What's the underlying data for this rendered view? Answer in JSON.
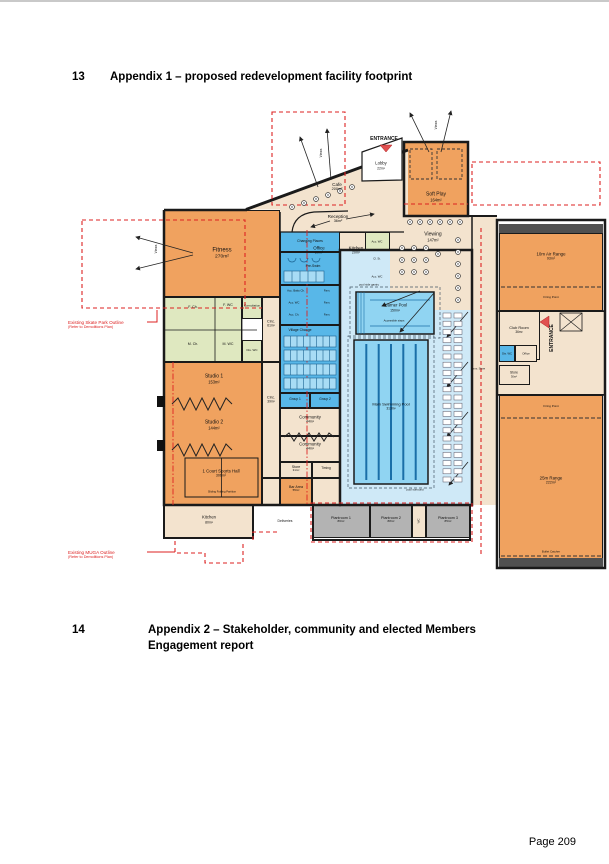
{
  "page": {
    "heading1": {
      "num": "13",
      "title": "Appendix 1 – proposed redevelopment facility footprint"
    },
    "heading2": {
      "num": "14",
      "title": "Appendix 2 – Stakeholder, community and elected Members",
      "title_line2": "Engagement report"
    },
    "footer": {
      "page_label": "Page 209"
    }
  },
  "colors": {
    "wall": "#1A1A1A",
    "red": "#DD2222",
    "orange": "#F0A25F",
    "tan": "#F3E3CE",
    "green": "#DFE8C0",
    "blue": "#58B7E8",
    "poolFloor": "#CFE9F7",
    "water": "#90D4F2",
    "gray": "#B3B3B3",
    "dark": "#505050",
    "laneBlue": "#1A6FA8",
    "entrancePink": "#E05050"
  },
  "plan": {
    "rooms": [
      {
        "name": "room-fitness",
        "x": 164,
        "y": 210,
        "w": 116,
        "h": 87,
        "f": "orange"
      },
      {
        "name": "room-change-strip",
        "x": 164,
        "y": 297,
        "w": 78,
        "h": 65,
        "f": "green"
      },
      {
        "name": "room-consultation",
        "x": 242,
        "y": 297,
        "w": 20,
        "h": 22,
        "f": "green"
      },
      {
        "name": "room-dis-wc-left",
        "x": 242,
        "y": 340,
        "w": 20,
        "h": 22,
        "f": "green"
      },
      {
        "name": "room-circ-61",
        "x": 262,
        "y": 297,
        "w": 18,
        "h": 65,
        "f": "tan"
      },
      {
        "name": "room-studios",
        "x": 164,
        "y": 362,
        "w": 98,
        "h": 143,
        "f": "orange"
      },
      {
        "name": "room-circ-39",
        "x": 262,
        "y": 362,
        "w": 18,
        "h": 116,
        "f": "tan"
      },
      {
        "name": "room-south-corridor",
        "x": 262,
        "y": 478,
        "w": 18,
        "h": 27,
        "f": "tan"
      },
      {
        "name": "room-kitchen-bottom",
        "x": 164,
        "y": 505,
        "w": 89,
        "h": 33,
        "f": "tan"
      },
      {
        "name": "room-reception-zone",
        "x": 280,
        "y": 212,
        "w": 124,
        "h": 20,
        "f": "tan",
        "nb": 1
      },
      {
        "name": "room-office",
        "x": 300,
        "y": 232,
        "w": 38,
        "h": 38,
        "f": "tan"
      },
      {
        "name": "room-kitchen-20",
        "x": 338,
        "y": 232,
        "w": 36,
        "h": 38,
        "f": "tan"
      },
      {
        "name": "room-wc-block",
        "x": 365,
        "y": 232,
        "w": 25,
        "h": 56,
        "f": "green"
      },
      {
        "name": "room-changing-places",
        "x": 280,
        "y": 230,
        "w": 60,
        "h": 22,
        "f": "blue"
      },
      {
        "name": "room-pre-swim",
        "x": 280,
        "y": 252,
        "w": 60,
        "h": 33,
        "f": "blue"
      },
      {
        "name": "room-acc-change",
        "x": 280,
        "y": 285,
        "w": 60,
        "h": 40,
        "f": "blue"
      },
      {
        "name": "room-village-change",
        "x": 280,
        "y": 325,
        "w": 60,
        "h": 68,
        "f": "blue"
      },
      {
        "name": "room-group-1",
        "x": 280,
        "y": 393,
        "w": 30,
        "h": 15,
        "f": "blue"
      },
      {
        "name": "room-group-2",
        "x": 310,
        "y": 393,
        "w": 30,
        "h": 15,
        "f": "blue"
      },
      {
        "name": "room-community-1",
        "x": 280,
        "y": 408,
        "w": 60,
        "h": 28,
        "f": "tan"
      },
      {
        "name": "room-community-2",
        "x": 280,
        "y": 436,
        "w": 60,
        "h": 26,
        "f": "tan"
      },
      {
        "name": "room-store-31",
        "x": 280,
        "y": 462,
        "w": 32,
        "h": 16,
        "f": "tan"
      },
      {
        "name": "room-timing",
        "x": 312,
        "y": 462,
        "w": 28,
        "h": 16,
        "f": "tan"
      },
      {
        "name": "room-bar-area",
        "x": 280,
        "y": 478,
        "w": 32,
        "h": 27,
        "f": "orange"
      },
      {
        "name": "room-pool-store",
        "x": 312,
        "y": 478,
        "w": 28,
        "h": 27,
        "f": "tan"
      },
      {
        "name": "room-pool-hall",
        "x": 340,
        "y": 250,
        "w": 132,
        "h": 255,
        "f": "poolFloor"
      },
      {
        "name": "room-viewing",
        "x": 390,
        "y": 216,
        "w": 107,
        "h": 94,
        "f": "tan",
        "nb": 1
      },
      {
        "name": "room-east-corridor",
        "x": 472,
        "y": 216,
        "w": 25,
        "h": 289,
        "f": "tan",
        "nb": 1
      },
      {
        "name": "room-soft-play",
        "x": 404,
        "y": 142,
        "w": 64,
        "h": 74,
        "f": "orange"
      },
      {
        "name": "room-wing-mid",
        "x": 497,
        "y": 311,
        "w": 108,
        "h": 84,
        "f": "tan"
      },
      {
        "name": "room-club-room",
        "x": 499,
        "y": 311,
        "w": 41,
        "h": 49,
        "f": "tan"
      },
      {
        "name": "room-dis-wc-wing",
        "x": 499,
        "y": 345,
        "w": 16,
        "h": 17,
        "f": "blue"
      },
      {
        "name": "room-office-wing",
        "x": 515,
        "y": 345,
        "w": 22,
        "h": 17,
        "f": "tan"
      },
      {
        "name": "room-store-30",
        "x": 499,
        "y": 365,
        "w": 31,
        "h": 20,
        "f": "tan"
      },
      {
        "name": "room-bullet-catcher-top",
        "x": 499,
        "y": 224,
        "w": 104,
        "h": 9,
        "f": "dark",
        "nb": 1
      },
      {
        "name": "room-air-range",
        "x": 499,
        "y": 233,
        "w": 104,
        "h": 78,
        "f": "orange"
      },
      {
        "name": "room-25m-range",
        "x": 499,
        "y": 395,
        "w": 104,
        "h": 173,
        "f": "orange"
      },
      {
        "name": "room-bullet-catcher-bottom",
        "x": 499,
        "y": 558,
        "w": 104,
        "h": 9,
        "f": "dark",
        "nb": 1
      },
      {
        "name": "room-plantroom-1",
        "x": 313,
        "y": 505,
        "w": 57,
        "h": 33,
        "f": "gray"
      },
      {
        "name": "room-plantroom-2",
        "x": 370,
        "y": 505,
        "w": 42,
        "h": 33,
        "f": "gray"
      },
      {
        "name": "room-wc-plant",
        "x": 412,
        "y": 505,
        "w": 14,
        "h": 33,
        "f": "tan"
      },
      {
        "name": "room-plantroom-3",
        "x": 426,
        "y": 505,
        "w": 44,
        "h": 33,
        "f": "gray"
      }
    ],
    "labels": [
      {
        "name": "fitness-label",
        "t": "Fitness",
        "s": "270m²",
        "x": 222,
        "y": 254,
        "fs": 6
      },
      {
        "name": "f-ch-label",
        "t": "F. Ch.",
        "x": 193,
        "y": 307,
        "fs": 3.6
      },
      {
        "name": "f-wc-label",
        "t": "F. WC",
        "x": 228,
        "y": 305,
        "fs": 3.6
      },
      {
        "name": "m-ch-label",
        "t": "M. Ch.",
        "x": 193,
        "y": 344,
        "fs": 3.6
      },
      {
        "name": "m-wc-label",
        "t": "M. WC",
        "x": 228,
        "y": 344,
        "fs": 3.6
      },
      {
        "name": "consultation-label",
        "t": "Consultation",
        "x": 252,
        "y": 306,
        "fs": 2.9
      },
      {
        "name": "dis-wc-left-label",
        "t": "Dis. WC",
        "x": 252,
        "y": 351,
        "fs": 3
      },
      {
        "name": "circ-61-label",
        "t": "Circ.",
        "s": "61m²",
        "x": 271,
        "y": 324,
        "fs": 4
      },
      {
        "name": "studio-1-label",
        "t": "Studio 1",
        "s": "153m²",
        "x": 214,
        "y": 380,
        "fs": 5
      },
      {
        "name": "studio-2-label",
        "t": "Studio 2",
        "s": "144m²",
        "x": 214,
        "y": 426,
        "fs": 5
      },
      {
        "name": "sports-hall-label",
        "t": "1 Court Sports Hall",
        "s": "306m²",
        "x": 221,
        "y": 473,
        "fs": 4.4,
        "w": 54
      },
      {
        "name": "circ-39-label",
        "t": "Circ.",
        "s": "39m²",
        "x": 271,
        "y": 400,
        "fs": 4
      },
      {
        "name": "kitchen-bottom-label",
        "t": "Kitchen",
        "s": "80m²",
        "x": 209,
        "y": 520,
        "fs": 4.2
      },
      {
        "name": "changing-places-label",
        "t": "Changing Places",
        "x": 310,
        "y": 241,
        "fs": 3.4
      },
      {
        "name": "pre-swim-label",
        "t": "Pre-Swim",
        "x": 313,
        "y": 266,
        "fs": 3.4
      },
      {
        "name": "acc-baby-ch-label",
        "t": "Acc. Baby Ch.",
        "x": 296,
        "y": 291,
        "fs": 2.8
      },
      {
        "name": "acc-wc-central-label",
        "t": "Acc. WC",
        "x": 294,
        "y": 303,
        "fs": 2.8
      },
      {
        "name": "acc-ch-label",
        "t": "Acc. Ch.",
        "x": 294,
        "y": 315,
        "fs": 2.8
      },
      {
        "name": "fam-1-label",
        "t": "Fam.",
        "x": 327,
        "y": 291,
        "fs": 2.8
      },
      {
        "name": "fam-2-label",
        "t": "Fam.",
        "x": 327,
        "y": 303,
        "fs": 2.8
      },
      {
        "name": "fam-3-label",
        "t": "Fam.",
        "x": 327,
        "y": 315,
        "fs": 2.8
      },
      {
        "name": "village-change-label",
        "t": "Village Change",
        "x": 300,
        "y": 330,
        "fs": 3.4
      },
      {
        "name": "group-1-label",
        "t": "Group 1",
        "x": 295,
        "y": 400,
        "fs": 3.2
      },
      {
        "name": "group-2-label",
        "t": "Group 2",
        "x": 325,
        "y": 400,
        "fs": 3.2
      },
      {
        "name": "community-1-label",
        "t": "Community",
        "s": "44m²",
        "x": 310,
        "y": 419,
        "fs": 4.3
      },
      {
        "name": "community-2-label",
        "t": "Community",
        "s": "44m²",
        "x": 310,
        "y": 446,
        "fs": 4.3
      },
      {
        "name": "store-31-label",
        "t": "Store",
        "s": "31m²",
        "x": 296,
        "y": 469,
        "fs": 3.6
      },
      {
        "name": "timing-label",
        "t": "Timing",
        "x": 326,
        "y": 469,
        "fs": 3.2
      },
      {
        "name": "bar-area-label",
        "t": "Bar Area",
        "s": "55m²",
        "x": 296,
        "y": 489,
        "fs": 3.6
      },
      {
        "name": "cafe-label",
        "t": "Cafe",
        "s": "200m²",
        "x": 337,
        "y": 187,
        "fs": 4.6
      },
      {
        "name": "reception-label",
        "t": "Reception",
        "s": "36m²",
        "x": 338,
        "y": 219,
        "fs": 4.6
      },
      {
        "name": "office-label",
        "t": "Office",
        "s": "20m²",
        "x": 319,
        "y": 250,
        "fs": 4.4
      },
      {
        "name": "kitchen-20-label",
        "t": "Kitchen",
        "s": "20m²",
        "x": 356,
        "y": 250,
        "fs": 4.4
      },
      {
        "name": "acc-wc-1-label",
        "t": "Acc. WC",
        "x": 377,
        "y": 242,
        "fs": 2.8
      },
      {
        "name": "cl-st-label",
        "t": "Cl. St.",
        "x": 377,
        "y": 259,
        "fs": 2.8
      },
      {
        "name": "acc-wc-2-label",
        "t": "Acc. WC",
        "x": 377,
        "y": 277,
        "fs": 2.8
      },
      {
        "name": "viewing-label",
        "t": "Viewing",
        "s": "147m²",
        "x": 433,
        "y": 238,
        "fs": 5
      },
      {
        "name": "lobby-label",
        "t": "Lobby",
        "s": "22m²",
        "x": 381,
        "y": 166,
        "fs": 4.2
      },
      {
        "name": "soft-play-label",
        "t": "Soft Play",
        "s": "164m²",
        "x": 436,
        "y": 198,
        "fs": 5
      },
      {
        "name": "learner-pool-label",
        "t": "Learner Pool",
        "s": "150m²",
        "x": 395,
        "y": 308,
        "fs": 4.2
      },
      {
        "name": "accessible-steps-label",
        "t": "Accessible steps",
        "x": 394,
        "y": 321,
        "fs": 2.8
      },
      {
        "name": "pool-gantry-label",
        "t": "pool side gantry",
        "x": 369,
        "y": 285,
        "fs": 2.8
      },
      {
        "name": "main-pool-label",
        "t": "Main Swimming Pool",
        "s": "313m²",
        "x": 391,
        "y": 407,
        "fs": 4,
        "w": 50
      },
      {
        "name": "pool-surround-label",
        "t": "pool surround",
        "x": 415,
        "y": 490,
        "fs": 2.8
      },
      {
        "name": "air-range-label",
        "t": "10m Air Range",
        "s": "93m²",
        "x": 551,
        "y": 256,
        "fs": 4.4
      },
      {
        "name": "firing-point-10-label",
        "t": "Firing Point",
        "x": 551,
        "y": 298,
        "fs": 3
      },
      {
        "name": "club-room-label",
        "t": "Club Room",
        "s": "36m²",
        "x": 519,
        "y": 330,
        "fs": 3.9
      },
      {
        "name": "dis-wc-wing-label",
        "t": "Dis. WC",
        "x": 507,
        "y": 354,
        "fs": 2.7
      },
      {
        "name": "office-wing-label",
        "t": "Office",
        "x": 526,
        "y": 354,
        "fs": 2.9
      },
      {
        "name": "store-30-label",
        "t": "Store",
        "s": "30m²",
        "x": 514,
        "y": 375,
        "fs": 3.3
      },
      {
        "name": "amm-store-label",
        "t": "Amm. Store",
        "x": 478,
        "y": 369,
        "fs": 2.7
      },
      {
        "name": "firing-point-25-label",
        "t": "Firing Point",
        "x": 551,
        "y": 407,
        "fs": 3
      },
      {
        "name": "range-25-label",
        "t": "25m Range",
        "s": "222m²",
        "x": 551,
        "y": 480,
        "fs": 4.4
      },
      {
        "name": "bullet-catcher-label",
        "t": "Bullet Catcher",
        "x": 551,
        "y": 552,
        "fs": 2.9
      },
      {
        "name": "plantroom-1-label",
        "t": "Plantroom 1",
        "s": "86m²",
        "x": 341,
        "y": 520,
        "fs": 3.7
      },
      {
        "name": "plantroom-2-label",
        "t": "Plantroom 2",
        "s": "88m²",
        "x": 391,
        "y": 520,
        "fs": 3.7
      },
      {
        "name": "wc-plant-label",
        "t": "WC",
        "x": 419,
        "y": 521,
        "fs": 2.9,
        "rot": 1
      },
      {
        "name": "plantroom-3-label",
        "t": "Plantroom 3",
        "s": "85m²",
        "x": 448,
        "y": 520,
        "fs": 3.7
      },
      {
        "name": "deliveries-label",
        "t": "Deliveries",
        "x": 285,
        "y": 521,
        "fs": 3.4
      },
      {
        "name": "sliding-partition-label",
        "t": "Sliding Folding Partition",
        "x": 222,
        "y": 492,
        "fs": 2.7
      },
      {
        "name": "entrance-top-label",
        "t": "ENTRANCE",
        "x": 384,
        "y": 140,
        "fs": 5,
        "b": 1
      },
      {
        "name": "entrance-side-label",
        "t": "ENTRANCE",
        "x": 553,
        "y": 338,
        "fs": 5,
        "b": 1,
        "rot": 1
      },
      {
        "name": "views-top-label",
        "t": "Views",
        "x": 322,
        "y": 153,
        "fs": 3.3,
        "rot": 1
      },
      {
        "name": "views-softplay-label",
        "t": "Views",
        "x": 437,
        "y": 125,
        "fs": 3.3,
        "rot": 1
      },
      {
        "name": "views-fitness-label",
        "t": "Views",
        "x": 157,
        "y": 249,
        "fs": 3.3,
        "rot": 1
      },
      {
        "name": "skate-park-note",
        "t": "Existing Skate Park Outline",
        "s": "(Refer to Demolitions Plan)",
        "x": 68,
        "y": 325,
        "fs": 4.6,
        "c": "red",
        "al": "l"
      },
      {
        "name": "muga-note",
        "t": "Existing MUGA Outline",
        "s": "(Refer to Demolitions Plan)",
        "x": 68,
        "y": 555,
        "fs": 4.6,
        "c": "red",
        "al": "l"
      }
    ]
  }
}
